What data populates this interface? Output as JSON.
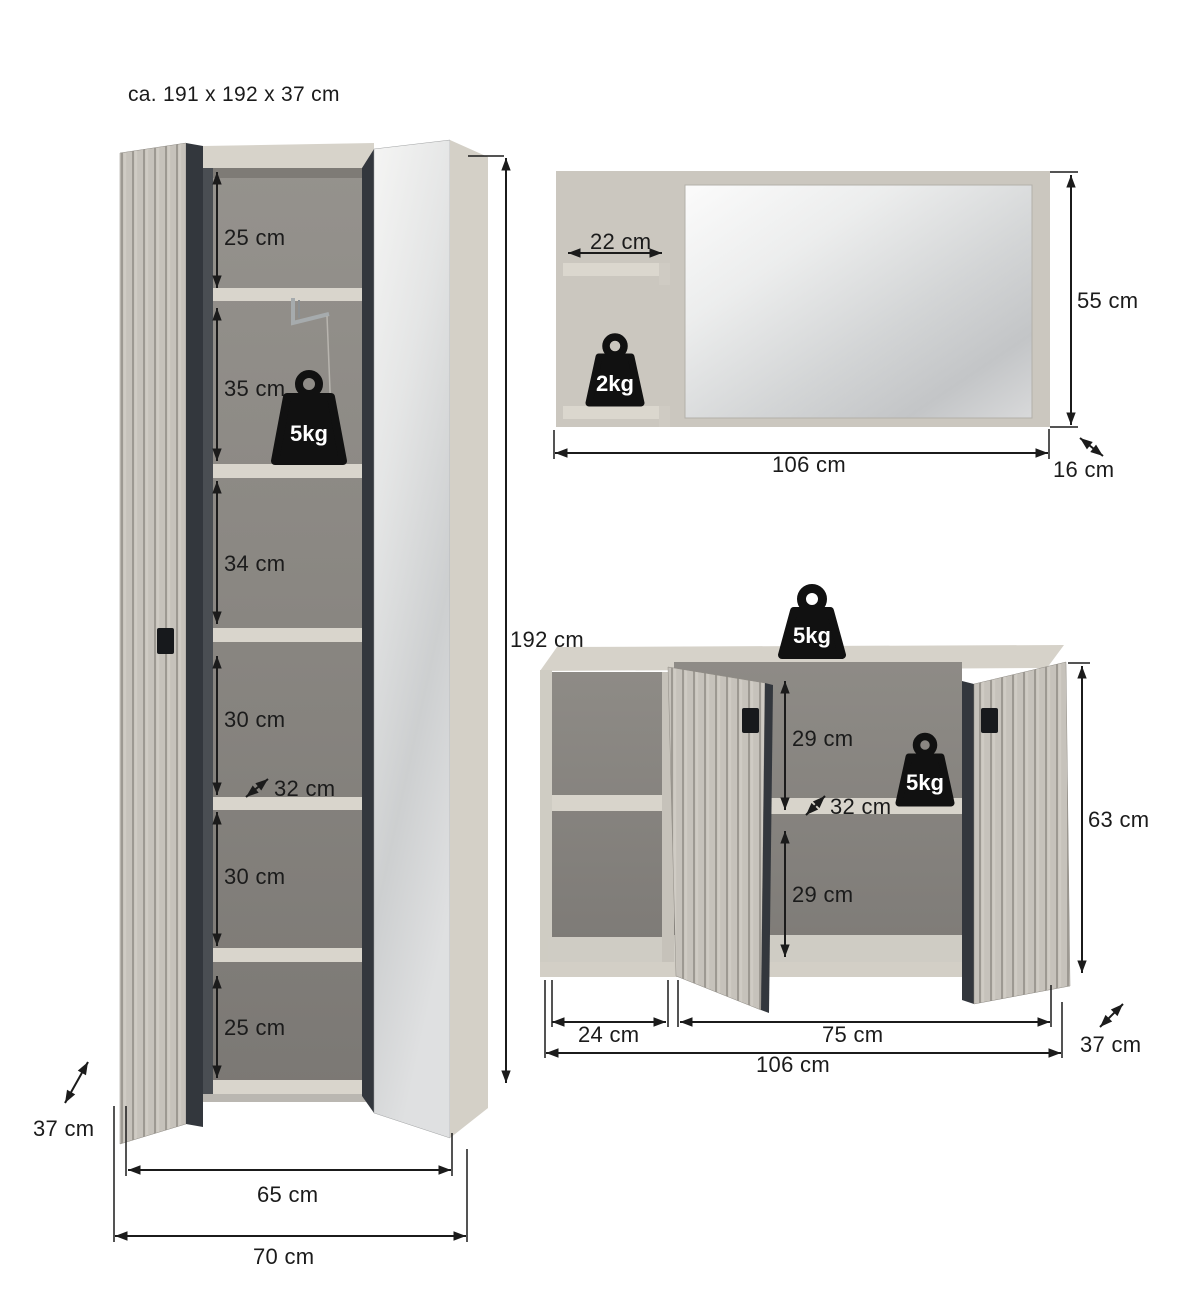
{
  "title": "ca. 191 x 192 x 37 cm",
  "colors": {
    "background": "#ffffff",
    "ink": "#1b1b1b",
    "front_greige": "#c6c2bb",
    "slat_gap": "#9d9992",
    "carcass_light": "#d6d2c9",
    "backboard": "#cbc7bf",
    "interior_gray": "#8f8c87",
    "edge_anthracite": "#33373d",
    "handle_black": "#17191c",
    "mirror_light": "#f5f5f4",
    "mirror_dark": "#c9cbcc",
    "weight_black": "#111111"
  },
  "wardrobe": {
    "sections": [
      {
        "label": "25 cm"
      },
      {
        "label": "35 cm"
      },
      {
        "label": "34 cm"
      },
      {
        "label": "30 cm"
      },
      {
        "label": "30 cm"
      },
      {
        "label": "25 cm"
      }
    ],
    "shelf_depth": "32 cm",
    "height": "192 cm",
    "depth": "37 cm",
    "inner_width": "65 cm",
    "outer_width": "70 cm",
    "max_load": "5kg"
  },
  "mirror_panel": {
    "shelf_width": "22 cm",
    "height": "55 cm",
    "width": "106 cm",
    "depth": "16 cm",
    "max_load": "2kg"
  },
  "sideboard": {
    "top_max_load": "5kg",
    "shelf_max_load": "5kg",
    "upper_compartment": "29 cm",
    "shelf_depth": "32 cm",
    "lower_compartment": "29 cm",
    "height": "63 cm",
    "left_width": "24 cm",
    "right_width": "75 cm",
    "width": "106 cm",
    "depth": "37 cm"
  }
}
